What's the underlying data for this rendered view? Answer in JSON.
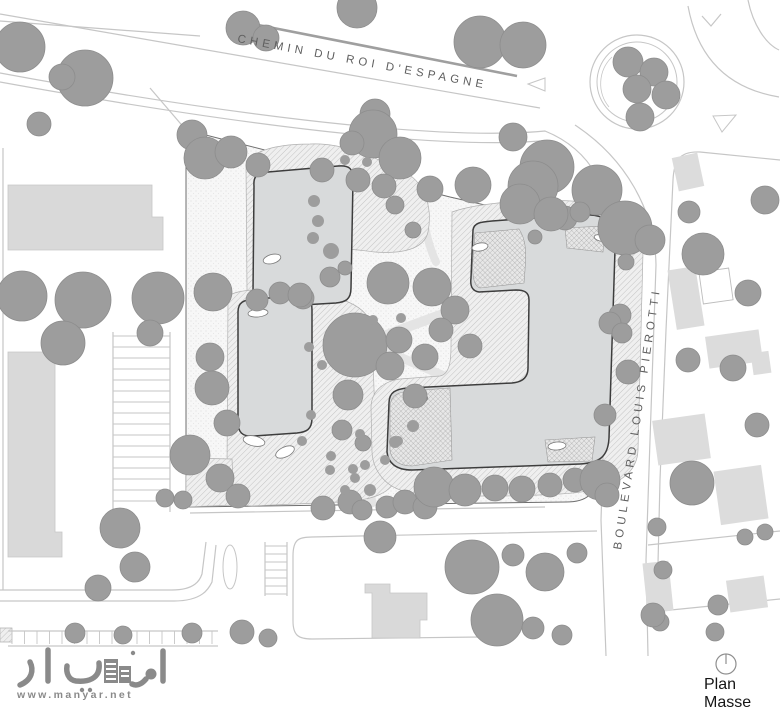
{
  "labels": {
    "street_top": "CHEMIN DU ROI D'ESPAGNE",
    "street_right": "BOULEVARD LOUIS PIEROTTI",
    "plan_line1": "Plan",
    "plan_line2": "Masse",
    "logo_arabic": "مانيار",
    "logo_url": "www.manyar.net"
  },
  "colors": {
    "bg": "#ffffff",
    "site_fill": "#f7f7f7",
    "site_dot": "#e2e2e2",
    "site_stroke": "#6f6f6f",
    "hatch_bg": "#efefef",
    "hatch_line": "#b0b0b0",
    "cross_bg": "#e7e7e7",
    "cross_line": "#9b9b9b",
    "building_fill": "#d8dadb",
    "building_stroke": "#3d3d3d",
    "flat_fill": "#d9d9d9",
    "flat_stroke": "#c6c6c6",
    "house_fill": "#dcdcdc",
    "house_outline": "#bdbdbd",
    "tree_fill": "#9d9d9d",
    "tree_stroke": "#8d8d8d",
    "road": "#c6c6c6",
    "road_bold": "#9f9f9f",
    "walkway": "#e4e4e4",
    "label": "#5f5f5f",
    "text": "#161616",
    "logo": "#8a8a8a",
    "oval_stroke": "#7a7a7a",
    "north_stroke": "#8f8f8f"
  },
  "plan": {
    "site": "M186,130 L450,197 L555,221 C585,231 596,243 596,260 L597,470 C597,496 585,502 566,502 L186,507 Z",
    "walkways": [
      {
        "d": "M370,148 C355,220 340,260 336,310 C332,360 322,430 318,506",
        "w": 13
      },
      {
        "d": "M232,372 C290,368 320,355 355,347 C400,330 430,318 455,310",
        "w": 10
      },
      {
        "d": "M300,292 C330,318 360,338 395,355 C430,370 455,380 470,388",
        "w": 9
      },
      {
        "d": "M345,398 C355,435 365,465 372,503",
        "w": 9
      },
      {
        "d": "M420,196 C424,225 428,245 436,262",
        "w": 8
      }
    ],
    "hatch_blobs": [
      "M246,165 C252,148 285,144 310,144 C345,142 380,160 405,172 C428,185 432,212 428,232 C424,250 400,254 375,252 C355,250 342,246 338,255 C336,275 337,292 330,303 C322,310 300,308 280,309 L262,310 C250,310 247,300 247,290 Z",
      "M228,296 C240,288 275,288 305,292 C335,296 370,303 372,330 L375,418 C392,423 397,436 398,448 L398,468 C398,496 365,501 340,502 L252,506 C232,506 227,488 227,470 Z",
      "M452,212 C480,202 540,198 585,202 C620,205 642,222 643,252 L638,450 C637,482 600,492 560,494 C510,497 440,497 408,492 C385,488 373,470 372,452 L371,408 C371,390 385,381 400,379 L440,376 C450,374 451,360 451,345 Z",
      "M186,458 L232,459 L234,505 L186,507 Z",
      "M0,628 L12,628 L12,642 L0,642 Z"
    ],
    "roads": [
      {
        "d": "M0,14 L540,108"
      },
      {
        "d": "M0,21 L200,36"
      },
      {
        "d": "M238,21 L517,76",
        "w": 2.6,
        "bold": true
      },
      {
        "d": "M0,73 C200,110 430,142 545,131 C592,150 613,192 612,245 L604,425 L601,520 L606,656"
      },
      {
        "d": "M0,82 C210,120 425,150 540,141"
      },
      {
        "d": "M575,125 C625,158 655,210 656,265 L650,440 L646,560 L648,656"
      },
      {
        "d": "M688,6 C697,55 725,88 779,97"
      },
      {
        "d": "M748,0 C753,25 766,44 779,50"
      },
      {
        "d": "M780,160 L700,152 C678,151 674,162 673,180 L666,330 L660,480 L657,605"
      },
      {
        "d": "M648,545 L780,531"
      },
      {
        "d": "M651,612 L780,599"
      },
      {
        "d": "M3,148 L3,590"
      },
      {
        "d": "M0,590 L172,590 C195,590 200,580 202,574 L206,542"
      },
      {
        "d": "M0,601 L174,601 C203,601 209,588 212,582 L216,545"
      },
      {
        "d": "M190,513 L545,507"
      },
      {
        "d": "M293,556 C293,540 298,537 312,537 L597,531"
      },
      {
        "d": "M293,556 L293,621 C293,635 298,639 312,639 L480,637"
      },
      {
        "d": "M186,130 L150,88"
      },
      {
        "d": "M113,332 L113,512"
      },
      {
        "d": "M170,332 L170,512"
      },
      {
        "d": "M265,542 L265,596"
      },
      {
        "d": "M287,542 L287,596"
      },
      {
        "d": "M8,631 L218,631"
      },
      {
        "d": "M8,646 L218,646"
      }
    ],
    "roundabout": {
      "cx": 637,
      "cy": 82,
      "ro": 47,
      "ri": 40,
      "arc": "M612,57 A37,37 0 0 0 609,107"
    },
    "island": {
      "cx": 230,
      "cy": 567,
      "rx": 7,
      "ry": 22
    },
    "triangles": [
      "528,84 545,78 545,91",
      "713,116 736,115 722,132"
    ],
    "chevron": "M702,16 L711,26 L721,14",
    "stripe_groups": [
      {
        "o": "h",
        "x1": 113,
        "x2": 170,
        "y": 336,
        "n": 16,
        "step": 11
      },
      {
        "o": "h",
        "x1": 265,
        "x2": 287,
        "y": 546,
        "n": 7,
        "step": 8
      },
      {
        "o": "v",
        "y1": 631,
        "y2": 644,
        "x": 12,
        "n": 17,
        "step": 12.5
      }
    ],
    "flat_buildings": [
      "M8,185 L152,185 L152,217 L163,217 L163,250 L8,250 Z",
      "M8,352 L55,352 L55,532 L62,532 L62,557 L8,557 Z",
      "M365,584 L390,584 L390,593 L427,593 L427,620 L420,620 L420,638 L372,638 L372,593 L365,593 Z"
    ],
    "houses": [
      {
        "x": 672,
        "y": 268,
        "w": 28,
        "h": 60,
        "r": -9
      },
      {
        "x": 707,
        "y": 333,
        "w": 54,
        "h": 32,
        "r": -8
      },
      {
        "x": 752,
        "y": 352,
        "w": 18,
        "h": 22,
        "r": -8
      },
      {
        "x": 655,
        "y": 417,
        "w": 53,
        "h": 45,
        "r": -8
      },
      {
        "x": 717,
        "y": 468,
        "w": 48,
        "h": 54,
        "r": -8
      },
      {
        "x": 728,
        "y": 578,
        "w": 38,
        "h": 32,
        "r": -8
      },
      {
        "x": 645,
        "y": 562,
        "w": 26,
        "h": 50,
        "r": -6
      },
      {
        "x": 675,
        "y": 155,
        "w": 26,
        "h": 34,
        "r": -12
      }
    ],
    "house_outlines": [
      {
        "x": 701,
        "y": 270,
        "w": 30,
        "h": 32,
        "r": -8
      }
    ],
    "buildings": [
      "M254,186 C253,175 258,173 268,172 L338,166 C350,165 353,169 353,180 L351,288 C351,300 345,302 336,303 L268,307 C256,308 253,303 253,293 Z",
      "M238,312 C238,302 244,300 254,299 L298,296 C309,295 312,300 312,310 L312,418 C312,430 306,432 297,433 L254,436 C242,437 238,432 238,422 Z",
      "M473,230 C474,223 480,222 492,221 L575,215 C600,213 612,219 613,232 L615,250 L609,438 C608,458 598,463 580,464 L412,470 C395,470 388,462 387,452 L389,403 C389,392 396,389 408,388 L512,383 C524,382 528,376 528,368 L529,300 C529,292 524,290 516,290 L479,292 C472,291 470,286 471,278 Z"
    ],
    "building_overlays": [
      "M475,233 L519,229 C527,241 526,255 525,270 L524,283 L480,288 C473,286 472,272 473,258 Z",
      "M390,406 C391,394 400,392 410,391 L450,388 L452,460 L412,466 C397,466 391,458 390,450 Z",
      "M545,440 L595,437 L592,461 L548,462 Z",
      "M565,228 L605,226 L603,252 L567,248 Z"
    ],
    "ovals": [
      {
        "cx": 272,
        "cy": 259,
        "rx": 9,
        "ry": 4.5,
        "r": -15
      },
      {
        "cx": 258,
        "cy": 313,
        "rx": 10,
        "ry": 4,
        "r": -5
      },
      {
        "cx": 254,
        "cy": 441,
        "rx": 11,
        "ry": 5,
        "r": 12
      },
      {
        "cx": 285,
        "cy": 452,
        "rx": 10,
        "ry": 5,
        "r": -25
      },
      {
        "cx": 480,
        "cy": 247,
        "rx": 8,
        "ry": 4,
        "r": -10
      },
      {
        "cx": 557,
        "cy": 446,
        "rx": 9,
        "ry": 4,
        "r": -5
      },
      {
        "cx": 420,
        "cy": 400,
        "rx": 8,
        "ry": 4,
        "r": -20
      },
      {
        "cx": 600,
        "cy": 238,
        "rx": 6,
        "ry": 3,
        "r": 15
      }
    ],
    "trees": [
      [
        20,
        47,
        25
      ],
      [
        85,
        78,
        28
      ],
      [
        62,
        77,
        13
      ],
      [
        39,
        124,
        12
      ],
      [
        243,
        28,
        17
      ],
      [
        266,
        38,
        13
      ],
      [
        357,
        8,
        20
      ],
      [
        480,
        42,
        26
      ],
      [
        523,
        45,
        23
      ],
      [
        628,
        62,
        15
      ],
      [
        654,
        72,
        14
      ],
      [
        637,
        89,
        14
      ],
      [
        666,
        95,
        14
      ],
      [
        640,
        117,
        14
      ],
      [
        547,
        167,
        27
      ],
      [
        597,
        190,
        25
      ],
      [
        625,
        228,
        27
      ],
      [
        626,
        262,
        8
      ],
      [
        565,
        218,
        12
      ],
      [
        580,
        212,
        10
      ],
      [
        650,
        240,
        15
      ],
      [
        513,
        137,
        14
      ],
      [
        375,
        114,
        15
      ],
      [
        373,
        134,
        24
      ],
      [
        352,
        143,
        12
      ],
      [
        400,
        158,
        21
      ],
      [
        473,
        185,
        18
      ],
      [
        533,
        186,
        25
      ],
      [
        322,
        170,
        12
      ],
      [
        358,
        180,
        12
      ],
      [
        384,
        186,
        12
      ],
      [
        430,
        189,
        13
      ],
      [
        192,
        135,
        15
      ],
      [
        205,
        158,
        21
      ],
      [
        231,
        152,
        16
      ],
      [
        258,
        165,
        12
      ],
      [
        22,
        296,
        25
      ],
      [
        83,
        300,
        28
      ],
      [
        158,
        298,
        26
      ],
      [
        213,
        292,
        19
      ],
      [
        63,
        343,
        22
      ],
      [
        150,
        333,
        13
      ],
      [
        212,
        388,
        17
      ],
      [
        227,
        423,
        13
      ],
      [
        210,
        357,
        14
      ],
      [
        190,
        455,
        20
      ],
      [
        220,
        478,
        14
      ],
      [
        238,
        496,
        12
      ],
      [
        257,
        300,
        11
      ],
      [
        280,
        293,
        11
      ],
      [
        303,
        298,
        11
      ],
      [
        355,
        345,
        32
      ],
      [
        388,
        283,
        21
      ],
      [
        432,
        287,
        19
      ],
      [
        455,
        310,
        14
      ],
      [
        300,
        295,
        12
      ],
      [
        330,
        277,
        10
      ],
      [
        348,
        395,
        15
      ],
      [
        390,
        366,
        14
      ],
      [
        399,
        340,
        13
      ],
      [
        425,
        357,
        13
      ],
      [
        441,
        330,
        12
      ],
      [
        470,
        346,
        12
      ],
      [
        415,
        396,
        12
      ],
      [
        342,
        430,
        10
      ],
      [
        363,
        443,
        8
      ],
      [
        345,
        268,
        7
      ],
      [
        520,
        204,
        20
      ],
      [
        551,
        214,
        17
      ],
      [
        395,
        205,
        9
      ],
      [
        413,
        230,
        8
      ],
      [
        535,
        237,
        7
      ],
      [
        323,
        508,
        12
      ],
      [
        350,
        502,
        12
      ],
      [
        362,
        510,
        10
      ],
      [
        387,
        507,
        11
      ],
      [
        405,
        502,
        12
      ],
      [
        425,
        507,
        12
      ],
      [
        434,
        487,
        20
      ],
      [
        465,
        490,
        16
      ],
      [
        495,
        488,
        13
      ],
      [
        522,
        489,
        13
      ],
      [
        550,
        485,
        12
      ],
      [
        575,
        480,
        12
      ],
      [
        600,
        480,
        20
      ],
      [
        607,
        495,
        12
      ],
      [
        620,
        315,
        11
      ],
      [
        610,
        323,
        11
      ],
      [
        622,
        333,
        10
      ],
      [
        605,
        415,
        11
      ],
      [
        628,
        372,
        12
      ],
      [
        689,
        212,
        11
      ],
      [
        703,
        254,
        21
      ],
      [
        765,
        200,
        14
      ],
      [
        748,
        293,
        13
      ],
      [
        688,
        360,
        12
      ],
      [
        733,
        368,
        13
      ],
      [
        757,
        425,
        12
      ],
      [
        692,
        483,
        22
      ],
      [
        657,
        527,
        9
      ],
      [
        745,
        537,
        8
      ],
      [
        765,
        532,
        8
      ],
      [
        663,
        570,
        9
      ],
      [
        718,
        605,
        10
      ],
      [
        660,
        622,
        9
      ],
      [
        715,
        632,
        9
      ],
      [
        380,
        537,
        16
      ],
      [
        472,
        567,
        27
      ],
      [
        497,
        620,
        26
      ],
      [
        513,
        555,
        11
      ],
      [
        545,
        572,
        19
      ],
      [
        577,
        553,
        10
      ],
      [
        533,
        628,
        11
      ],
      [
        562,
        635,
        10
      ],
      [
        653,
        615,
        12
      ],
      [
        120,
        528,
        20
      ],
      [
        135,
        567,
        15
      ],
      [
        98,
        588,
        13
      ],
      [
        165,
        498,
        9
      ],
      [
        183,
        500,
        9
      ],
      [
        75,
        633,
        10
      ],
      [
        123,
        635,
        9
      ],
      [
        192,
        633,
        10
      ],
      [
        242,
        632,
        12
      ],
      [
        268,
        638,
        9
      ]
    ],
    "shrubs": [
      [
        314,
        201,
        6
      ],
      [
        318,
        221,
        6
      ],
      [
        313,
        238,
        6
      ],
      [
        331,
        251,
        8
      ],
      [
        309,
        347,
        5
      ],
      [
        322,
        365,
        5
      ],
      [
        401,
        318,
        5
      ],
      [
        373,
        320,
        5
      ],
      [
        413,
        426,
        6
      ],
      [
        398,
        441,
        5
      ],
      [
        311,
        415,
        5
      ],
      [
        331,
        456,
        5
      ],
      [
        353,
        469,
        5
      ],
      [
        302,
        441,
        5
      ],
      [
        367,
        162,
        5
      ],
      [
        345,
        160,
        5
      ],
      [
        343,
        435,
        5
      ],
      [
        360,
        434,
        5
      ],
      [
        395,
        442,
        6
      ],
      [
        365,
        465,
        5
      ],
      [
        355,
        478,
        5
      ],
      [
        330,
        470,
        5
      ],
      [
        345,
        490,
        5
      ],
      [
        370,
        490,
        6
      ],
      [
        385,
        460,
        5
      ]
    ],
    "north_icon": {
      "cx": 726,
      "cy": 664,
      "r": 10,
      "hand": "M726,664 L726,654}"
    }
  }
}
